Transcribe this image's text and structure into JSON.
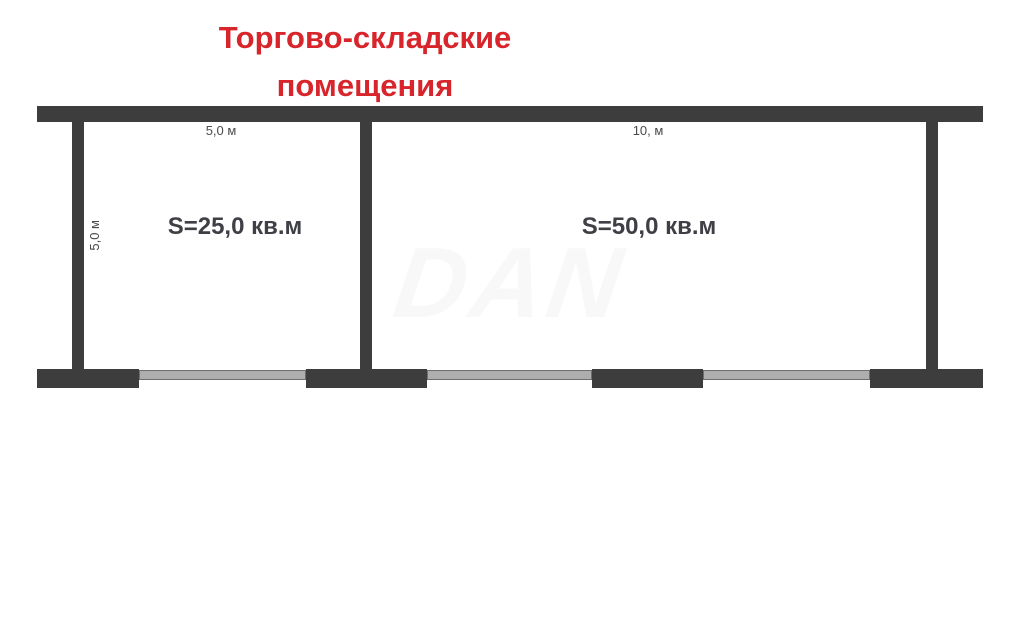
{
  "title": {
    "line1": "Торгово-складские",
    "line2": "помещения"
  },
  "rooms": [
    {
      "area_label": "S=25,0 кв.м",
      "width_label": "5,0 м",
      "height_label": "5,0 м"
    },
    {
      "area_label": "S=50,0 кв.м",
      "width_label": "10, м"
    }
  ],
  "watermark": "DAN",
  "colors": {
    "title": "#d7252b",
    "wall": "#3d3d3d",
    "window_fill": "#aeaeae",
    "window_border": "#6e6e6e",
    "label": "#3f3f46",
    "dim": "#4a4a4a",
    "watermark": "#f8f8f8"
  }
}
